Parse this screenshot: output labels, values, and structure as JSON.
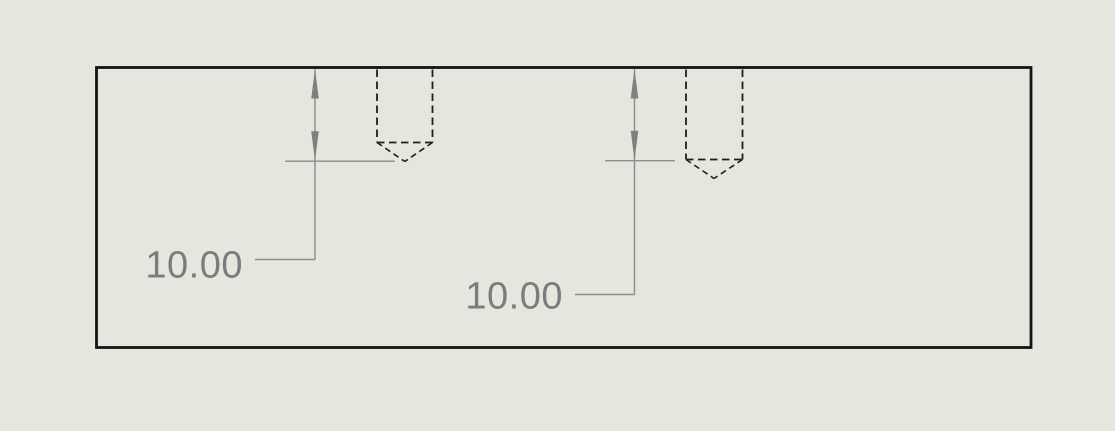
{
  "viewport": {
    "type": "cad-drawing-view",
    "background_color": "#e6e6de",
    "part_edge_color": "#141414",
    "hidden_line_color": "#1f1f1f",
    "dimension_line_color": "#8c8c8c",
    "dimension_text_color": "#7a7c7e"
  },
  "dimensions": [
    {
      "label": "10.00"
    },
    {
      "label": "10.00"
    }
  ]
}
